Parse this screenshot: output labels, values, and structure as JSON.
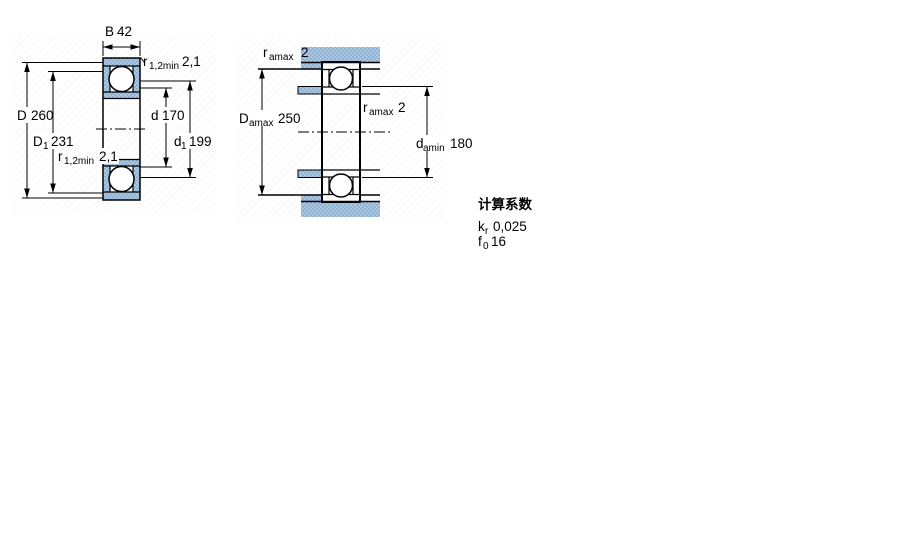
{
  "colors": {
    "line": "#000000",
    "hatch_base": "#a9c7e1",
    "hatch_dot": "#7fa4ca",
    "background": "#ffffff"
  },
  "figure_left": {
    "name": "bearing cross-section with boundary dimensions",
    "labels": {
      "b": {
        "symbol": "B",
        "value": "42"
      },
      "D": {
        "symbol": "D",
        "value": "260"
      },
      "D1": {
        "symbol": "D",
        "sub": "1",
        "value": "231"
      },
      "d": {
        "symbol": "d",
        "value": "170"
      },
      "d1": {
        "symbol": "d",
        "sub": "1",
        "value": "199"
      },
      "r_top": {
        "symbol": "r",
        "sub": "1,2min",
        "value": "2,1"
      },
      "r_bottom": {
        "symbol": "r",
        "sub": "1,2min",
        "value": "2,1"
      }
    }
  },
  "figure_right": {
    "name": "bearing mounted with abutment dimensions",
    "labels": {
      "r_housing": {
        "symbol": "r",
        "sub": "amax",
        "value": "2"
      },
      "D_amax": {
        "symbol": "D",
        "sub": "amax",
        "value": "250"
      },
      "r_shaft": {
        "symbol": "r",
        "sub": "amax",
        "value": "2"
      },
      "d_amin": {
        "symbol": "d",
        "sub": "amin",
        "value": "180"
      }
    }
  },
  "calculation_factors": {
    "title": "计算系数",
    "kr": {
      "symbol": "k",
      "sub": "r",
      "value": "0,025"
    },
    "f0": {
      "symbol": "f",
      "sub": "0",
      "value": "16"
    }
  }
}
